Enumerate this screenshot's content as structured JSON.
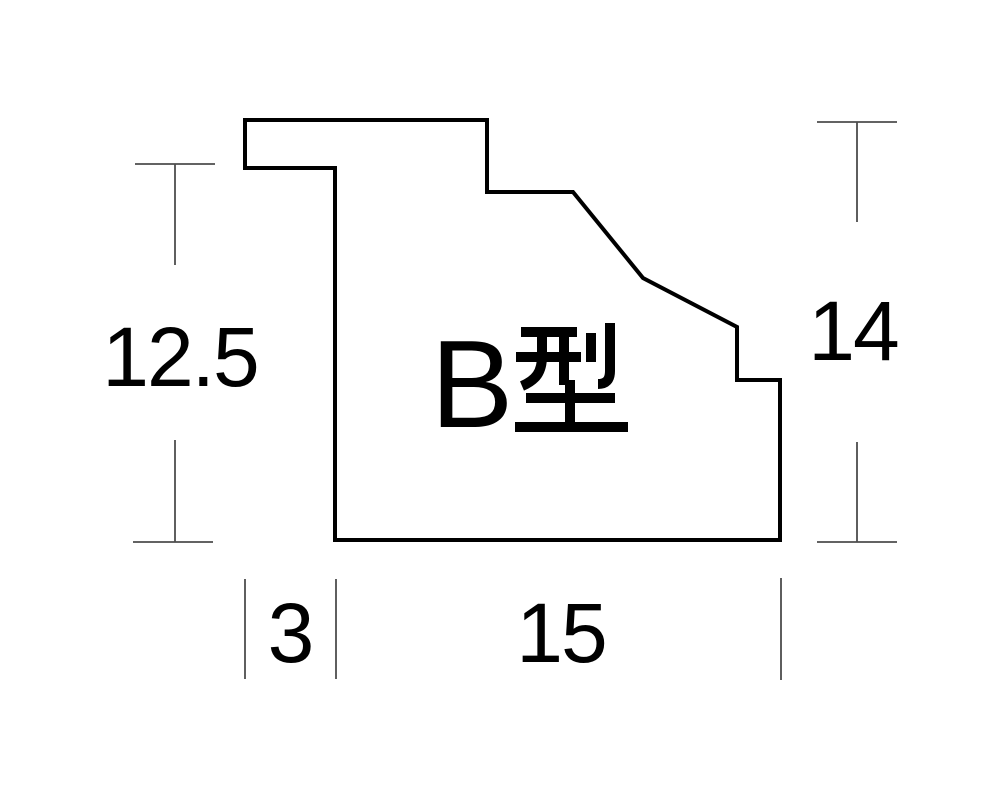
{
  "diagram": {
    "title_label": "B型",
    "title_label_parts": {
      "latin": "B",
      "kanji": "型"
    },
    "profile_outline_points": "245,120 487,120 487,192 573,192 643,278 737,327 737,380 780,380 780,540 335,540 335,168 245,168",
    "dimensions": {
      "left_height": {
        "value": "12.5",
        "orientation": "vertical",
        "measures": "overall height of left face"
      },
      "right_height": {
        "value": "14",
        "orientation": "vertical",
        "measures": "overall height of right face"
      },
      "rabbet_width": {
        "value": "3",
        "orientation": "horizontal",
        "measures": "lip overhang width"
      },
      "base_width": {
        "value": "15",
        "orientation": "horizontal",
        "measures": "base width"
      }
    },
    "colors": {
      "background": "#ffffff",
      "outline": "#000000",
      "dimension_lines": "#4d4d4d",
      "text": "#000000"
    }
  }
}
